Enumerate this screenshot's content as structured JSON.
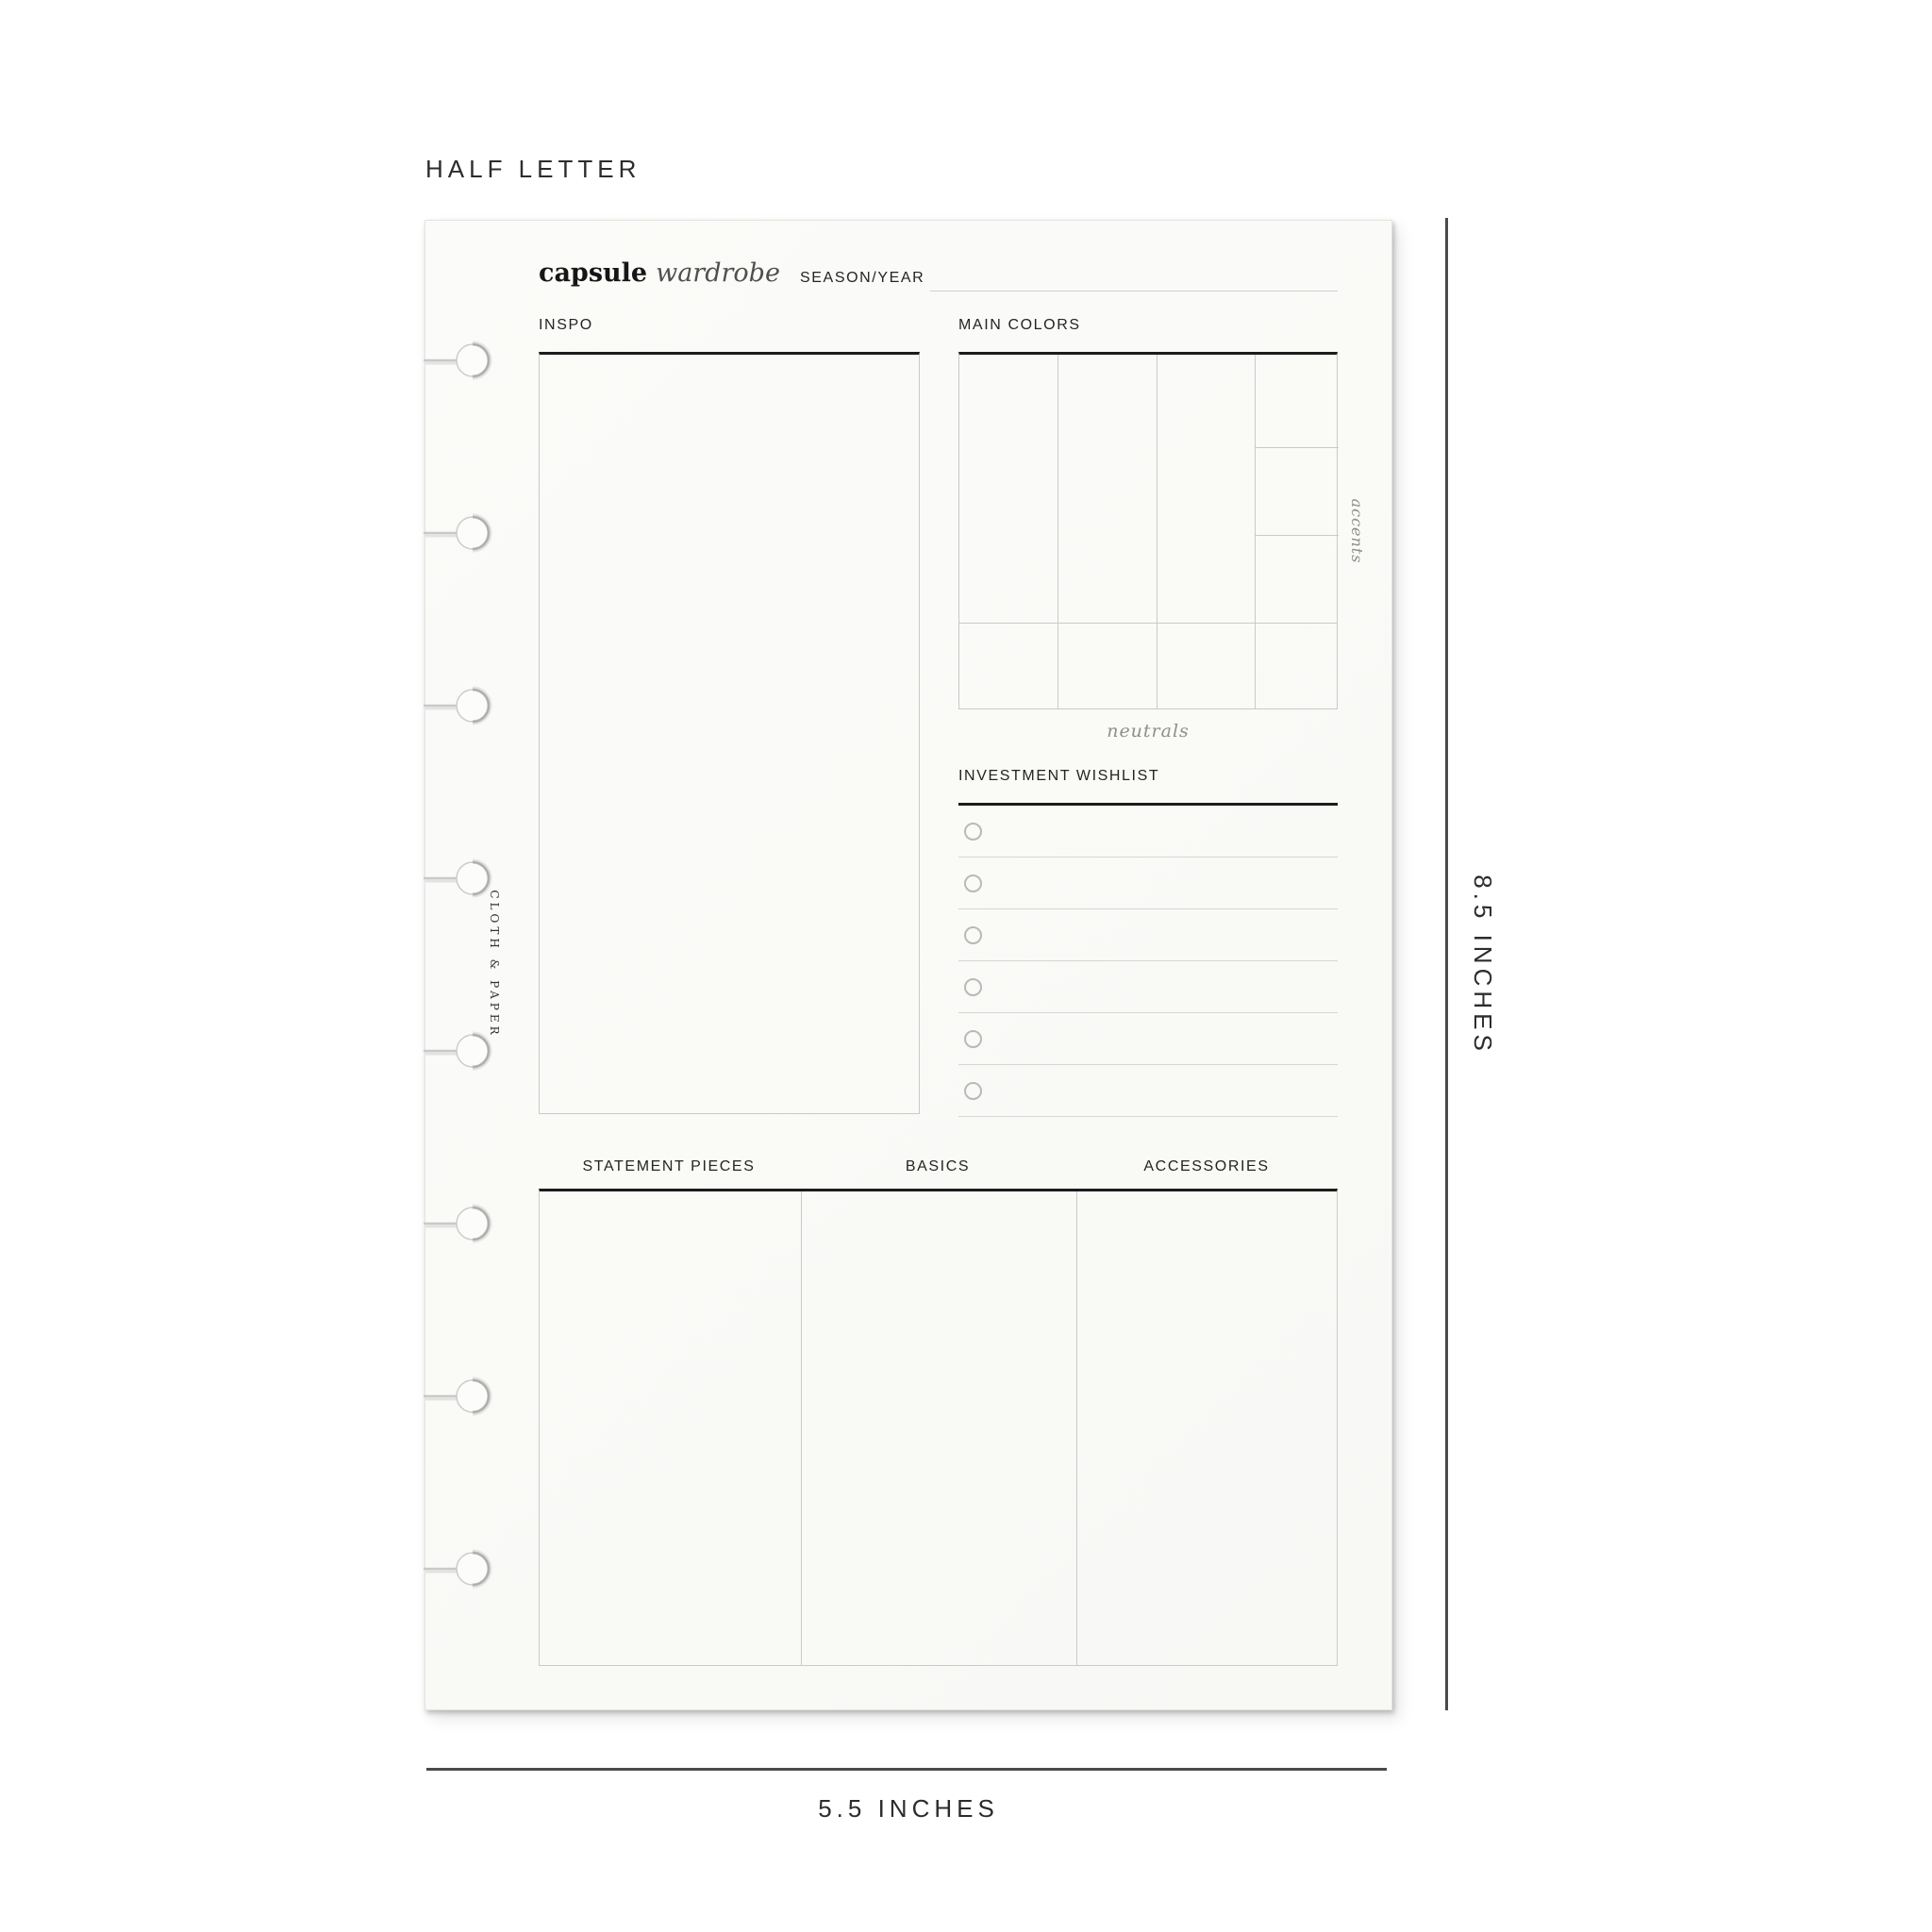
{
  "meta": {
    "size_name": "HALF LETTER",
    "height_label": "8.5 INCHES",
    "width_label": "5.5 INCHES"
  },
  "page": {
    "brand_vertical": "CLOTH & PAPER",
    "title_bold": "capsule",
    "title_italic": "wardrobe",
    "season_label": "SEASON/YEAR",
    "inspo_label": "INSPO",
    "main_colors_label": "MAIN COLORS",
    "accents_label": "accents",
    "neutrals_label": "neutrals",
    "wishlist_label": "INVESTMENT WISHLIST",
    "wishlist_rows": 6,
    "binding_holes": 8,
    "bottom_columns": [
      "STATEMENT PIECES",
      "BASICS",
      "ACCESSORIES"
    ]
  },
  "colors": {
    "paper": "#fafaf8",
    "heavy_line": "#1c1c1c",
    "light_line": "#c9c9c9",
    "row_line": "#d6d6d6",
    "muted_text": "#8e8e8e",
    "label_text": "#242424",
    "ruler_line": "#4a4a4a"
  }
}
